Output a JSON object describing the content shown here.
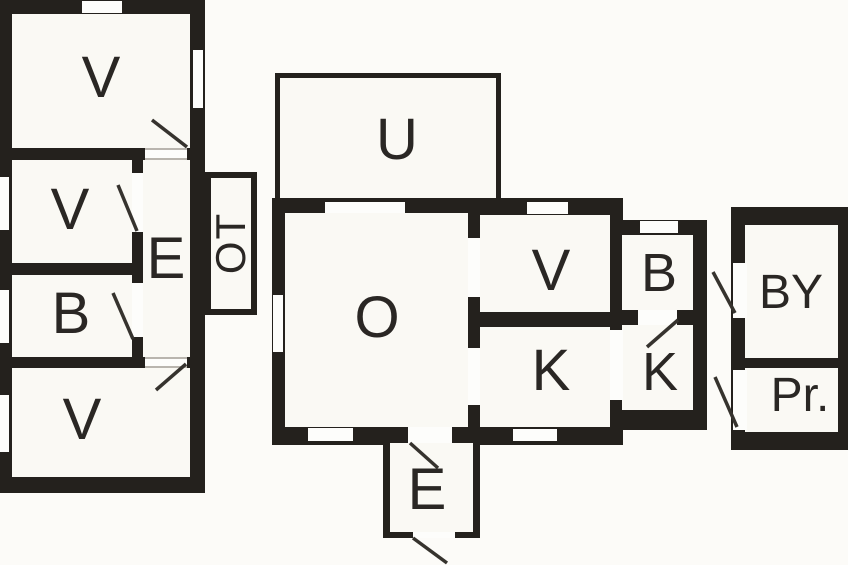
{
  "diagram": {
    "kind": "architectural floor plan, three detached buildings",
    "colors": {
      "background": "#fcfbf8",
      "wall": "#24211d",
      "room_fill": "#faf9f4",
      "opening_fill": "#fdfdfb",
      "door_line": "#36332e"
    },
    "buildings": {
      "left_house": {
        "rooms": {
          "v_top": {
            "label": "V"
          },
          "v_mid": {
            "label": "V"
          },
          "e_hall": {
            "label": "E"
          },
          "b_room": {
            "label": "B"
          },
          "v_bottom": {
            "label": "V"
          }
        },
        "ot_annex": {
          "label": "OT",
          "text_rotation_deg": -90
        }
      },
      "main_house": {
        "u_veranda": {
          "label": "U"
        },
        "rooms": {
          "o_room": {
            "label": "O"
          },
          "v_room": {
            "label": "V"
          },
          "k_room": {
            "label": "K"
          }
        },
        "side_annex": {
          "rooms": {
            "b_room": {
              "label": "B"
            },
            "k_room": {
              "label": "K"
            }
          }
        },
        "e_entry": {
          "label": "E"
        }
      },
      "outbuilding": {
        "rooms": {
          "by_room": {
            "label": "BY"
          },
          "pr_room": {
            "label": "Pr."
          }
        }
      }
    }
  }
}
